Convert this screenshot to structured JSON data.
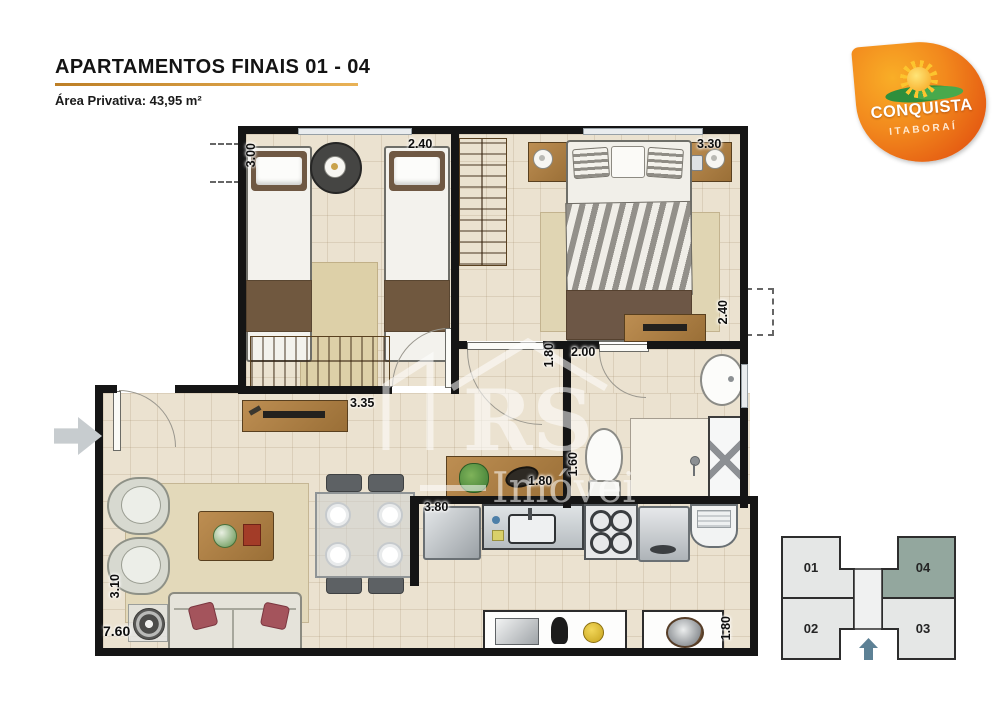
{
  "header": {
    "title": "APARTAMENTOS FINAIS 01 - 04",
    "area": "Área Privativa: 43,95 m²"
  },
  "logo": {
    "brand": "CONQUISTA",
    "location": "ITABORAÍ",
    "primary_color": "#e9661a",
    "accent_color": "#f9ae27"
  },
  "watermark": {
    "initials": "RS",
    "word": "Imóveis"
  },
  "plan": {
    "dimensions": {
      "bedroom2_width": "3.00",
      "bedroom2_length": "2.40",
      "master_length": "3.30",
      "master_depth": "2.40",
      "living_wall": "3.35",
      "hall_depth": "1.80",
      "bath_width": "2.00",
      "bath_depth": "1.60",
      "hall_cabinet": "1.80",
      "kitchen_width": "3.80",
      "living_depth": "3.10",
      "apartment_width": "7.60",
      "service_depth": "1.80"
    }
  },
  "keyplan": {
    "units": [
      "01",
      "02",
      "03",
      "04"
    ],
    "highlighted_unit": "04",
    "highlight_color": "#93a79e",
    "arrow_color": "#5d8195"
  }
}
